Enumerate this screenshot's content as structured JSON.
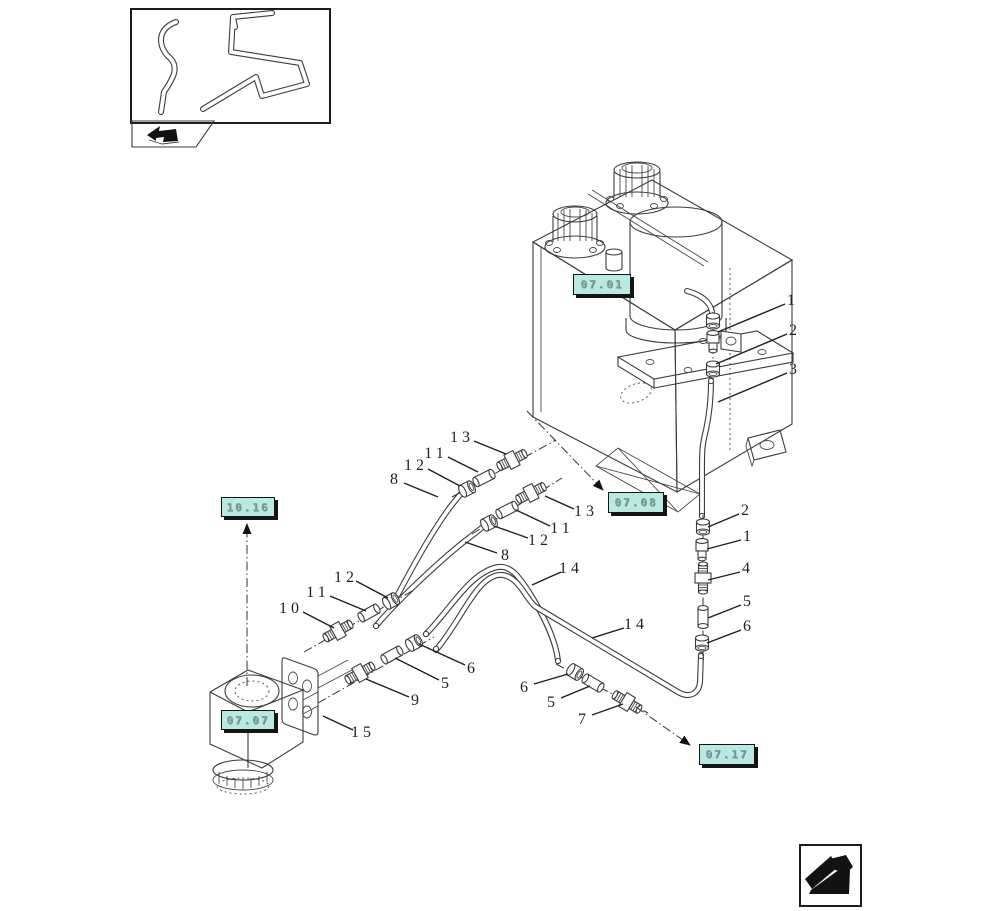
{
  "drawing_title": "hydraulic-brake-pipes-exploded-diagram",
  "colors": {
    "line": "#3c3c3c",
    "accent_fill": "#b9e9e2",
    "accent_text": "#7fa29c",
    "arrow": "#121212"
  },
  "icons": {
    "thumbnail": "bent-pipes-preview",
    "back_tab": "return-arrow-icon",
    "corner": "page-turn-arrow-icon"
  },
  "ref_boxes": [
    {
      "code": "07.01"
    },
    {
      "code": "10.16"
    },
    {
      "code": "07.08"
    },
    {
      "code": "07.07"
    },
    {
      "code": "07.17"
    }
  ],
  "callouts": [
    {
      "n": "1"
    },
    {
      "n": "2"
    },
    {
      "n": "3"
    },
    {
      "n": "2"
    },
    {
      "n": "1"
    },
    {
      "n": "4"
    },
    {
      "n": "5"
    },
    {
      "n": "6"
    },
    {
      "n": "13"
    },
    {
      "n": "11"
    },
    {
      "n": "12"
    },
    {
      "n": "8"
    },
    {
      "n": "13"
    },
    {
      "n": "11"
    },
    {
      "n": "12"
    },
    {
      "n": "8"
    },
    {
      "n": "14"
    },
    {
      "n": "14"
    },
    {
      "n": "12"
    },
    {
      "n": "11"
    },
    {
      "n": "10"
    },
    {
      "n": "9"
    },
    {
      "n": "5"
    },
    {
      "n": "6"
    },
    {
      "n": "6"
    },
    {
      "n": "5"
    },
    {
      "n": "7"
    },
    {
      "n": "15"
    }
  ]
}
